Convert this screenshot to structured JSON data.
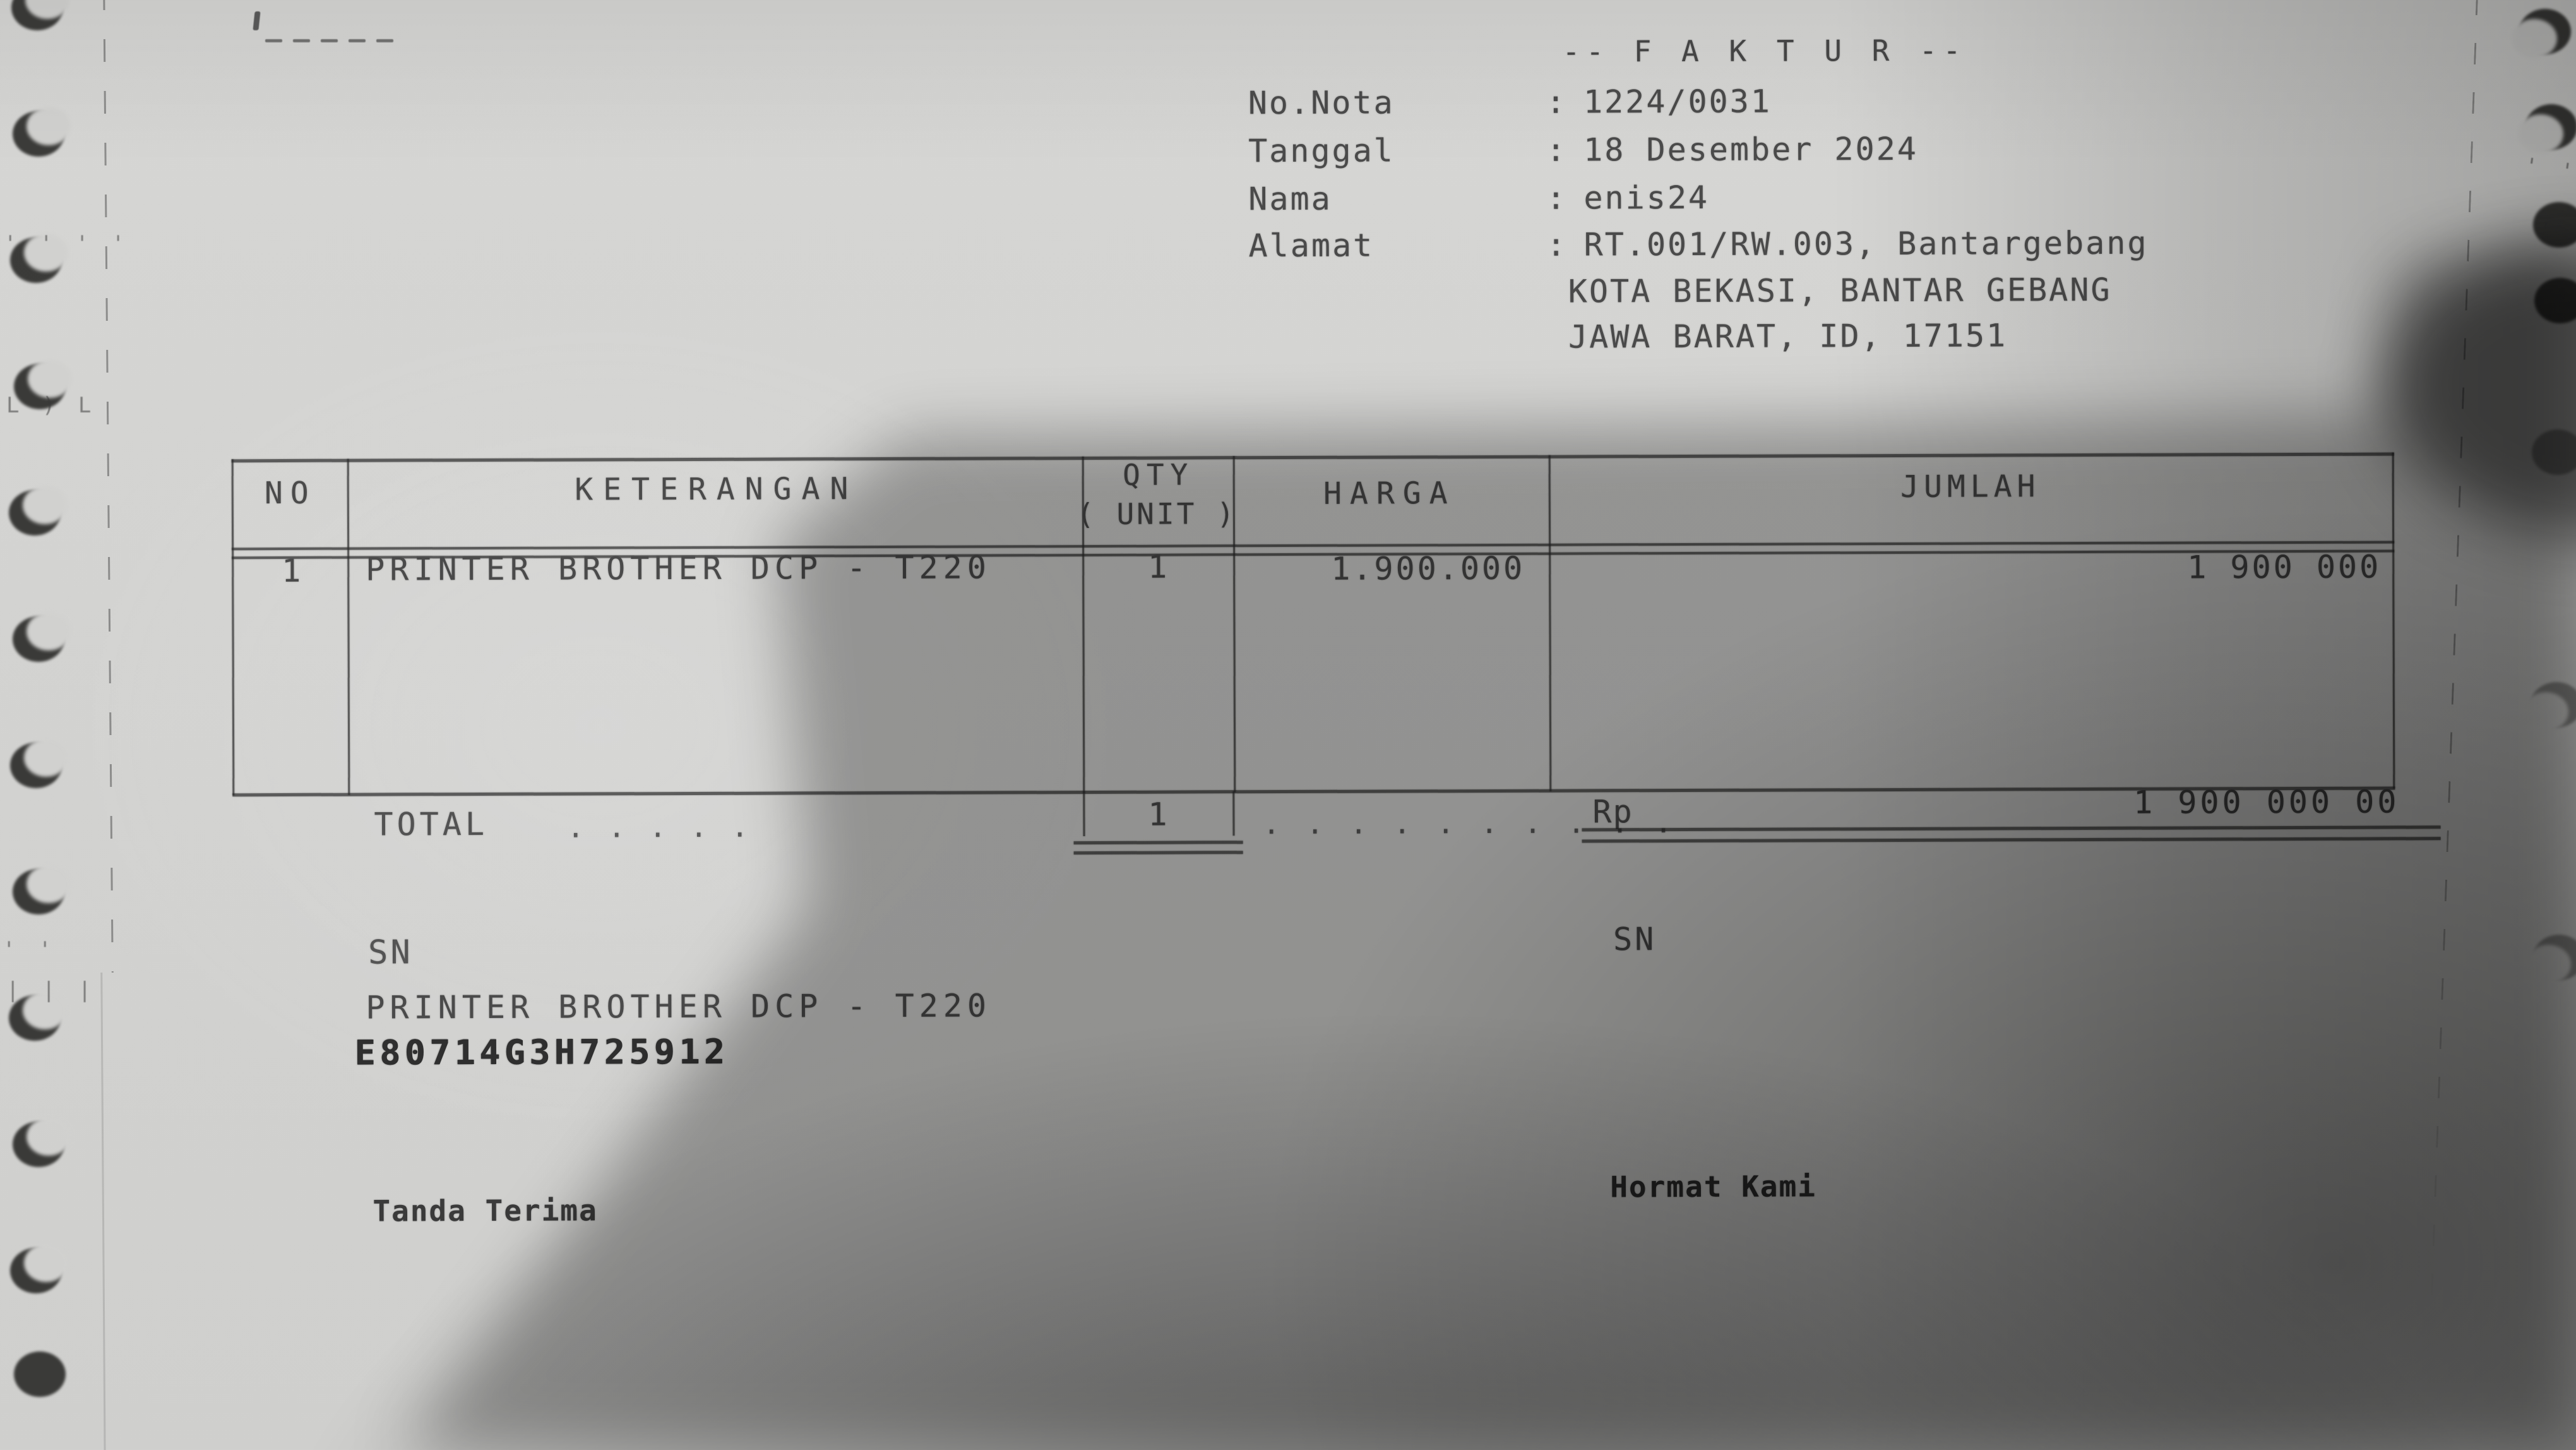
{
  "paper": {
    "background": "#d3d3d1",
    "ink": "#4a4a4a"
  },
  "header": {
    "title": "-- F A K T U R --",
    "separator": ":",
    "fields": [
      {
        "label": "No.Nota",
        "value": "1224/0031"
      },
      {
        "label": "Tanggal",
        "value": "18 Desember 2024"
      },
      {
        "label": "Nama",
        "value": "enis24"
      },
      {
        "label": "Alamat",
        "value": "RT.001/RW.003, Bantargebang"
      }
    ],
    "address_lines": [
      "KOTA BEKASI, BANTAR GEBANG",
      "JAWA BARAT, ID, 17151"
    ]
  },
  "table": {
    "headers": {
      "no": "NO",
      "keterangan": "KETERANGAN",
      "qty_top": "QTY",
      "qty_bottom": "( UNIT )",
      "harga": "HARGA",
      "jumlah": "JUMLAH"
    },
    "rows": [
      {
        "no": "1",
        "keterangan": "PRINTER BROTHER DCP - T220",
        "qty": "1",
        "harga": "1.900.000",
        "jumlah": "1 900 000"
      }
    ],
    "total": {
      "label": "TOTAL",
      "label_dots": ". . . . .",
      "qty": "1",
      "leader_dots": ". . . . . . . . . .",
      "currency": "Rp",
      "amount": "1 900 000 00"
    }
  },
  "sn_section": {
    "label_left": "SN",
    "product": "PRINTER BROTHER DCP - T220",
    "serial": "E80714G3H725912",
    "label_right": "SN"
  },
  "signatures": {
    "left": "Tanda Terima",
    "right": "Hormat Kami"
  },
  "margin_artifacts": {
    "left_marks": [
      "' ' ' '",
      "L ) L",
      "' '",
      "| | |"
    ],
    "right_marks": [
      "' ' '",
      "' ' '"
    ]
  }
}
